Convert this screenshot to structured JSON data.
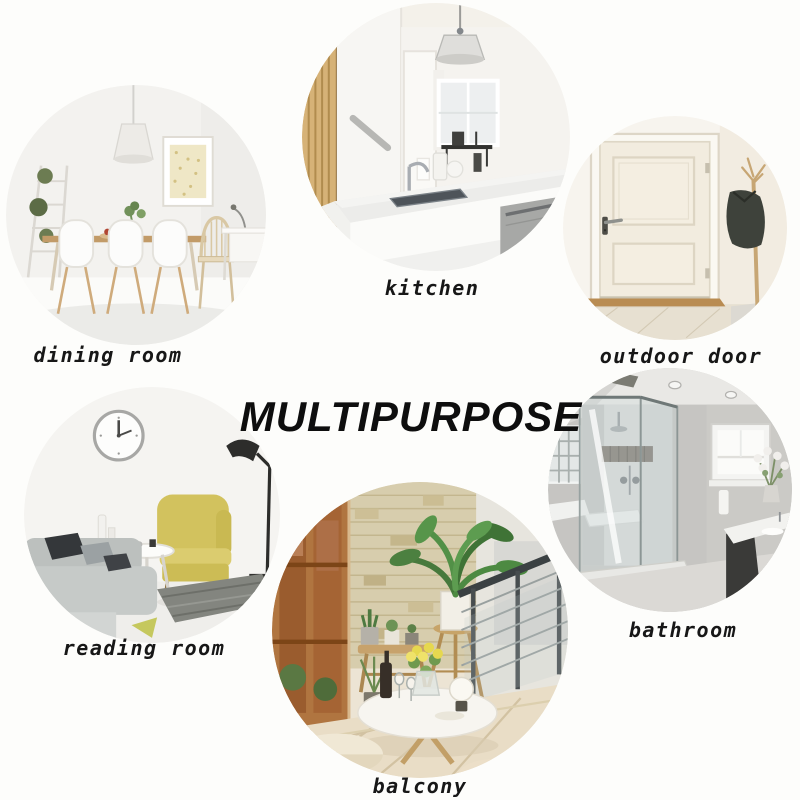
{
  "title": "MULTIPURPOSE",
  "colors": {
    "page_bg": "#fdfdfb",
    "title_ink": "#0e0e0e",
    "label_ink": "#171717"
  },
  "rooms": {
    "dining": {
      "label": "dining room"
    },
    "kitchen": {
      "label": "kitchen"
    },
    "outdoor": {
      "label": "outdoor door"
    },
    "reading": {
      "label": "reading room"
    },
    "bathroom": {
      "label": "bathroom"
    },
    "balcony": {
      "label": "balcony"
    }
  }
}
